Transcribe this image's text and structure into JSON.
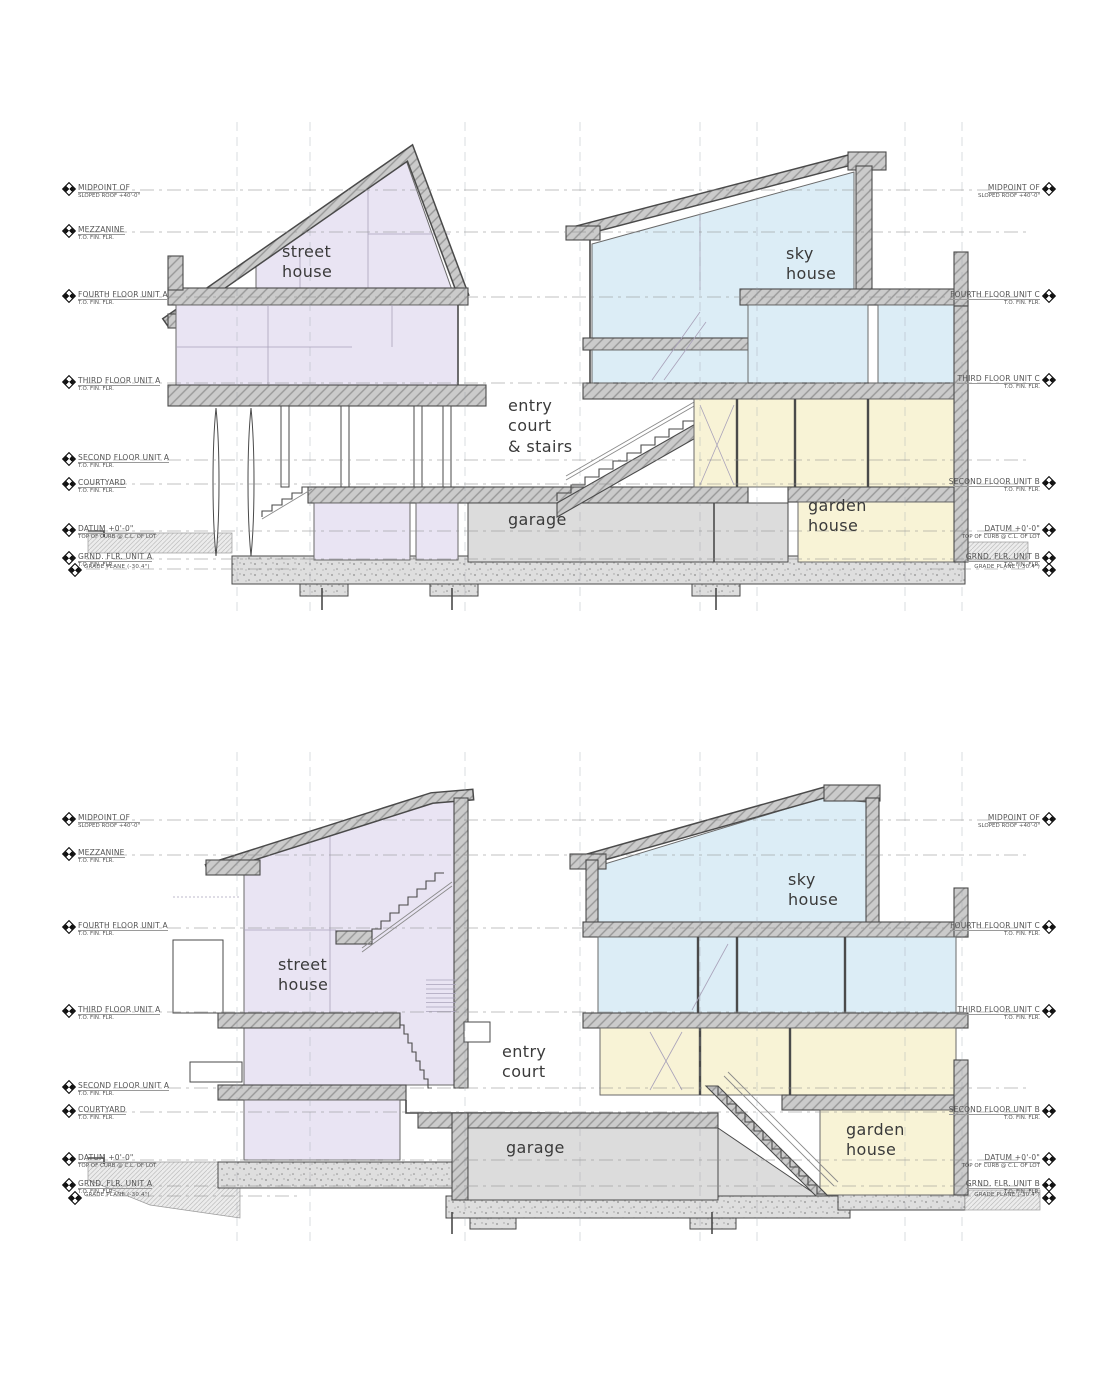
{
  "title": "residential building sections",
  "colors": {
    "street_house": "#e9e4f3",
    "sky_house": "#dcedf6",
    "garden_house": "#f8f3d6",
    "garage": "#dcdcdc",
    "concrete": "#cbcbcb",
    "line": "#4a4a4a"
  },
  "sections": [
    {
      "name": "upper section",
      "left_levels": [
        {
          "l1": "MIDPOINT OF",
          "l2": "SLOPED ROOF +40'-0\""
        },
        {
          "l1": "MEZZANINE",
          "l2": "T.O. FIN. FLR."
        },
        {
          "l1": "FOURTH FLOOR UNIT A",
          "l2": "T.O. FIN. FLR."
        },
        {
          "l1": "THIRD FLOOR UNIT A",
          "l2": "T.O. FIN. FLR."
        },
        {
          "l1": "SECOND FLOOR UNIT A",
          "l2": "T.O. FIN. FLR."
        },
        {
          "l1": "COURTYARD",
          "l2": "T.O. FIN. FLR."
        },
        {
          "l1": "DATUM +0'-0\"",
          "l2": "TOP OF CURB @ C.L. OF LOT"
        },
        {
          "l1": "GRND. FLR. UNIT A",
          "l2": "T.O. FIN. FLR."
        },
        {
          "l1": "GRADE PLANE (-30.4\")",
          "l2": ""
        }
      ],
      "right_levels": [
        {
          "l1": "MIDPOINT OF",
          "l2": "SLOPED ROOF +40'-0\""
        },
        {
          "l1": "FOURTH FLOOR UNIT C",
          "l2": "T.O. FIN. FLR."
        },
        {
          "l1": "THIRD FLOOR UNIT C",
          "l2": "T.O. FIN. FLR."
        },
        {
          "l1": "SECOND FLOOR UNIT B",
          "l2": "T.O. FIN. FLR."
        },
        {
          "l1": "DATUM +0'-0\"",
          "l2": "TOP OF CURB @ C.L. OF LOT"
        },
        {
          "l1": "GRND. FLR. UNIT B",
          "l2": "T.O. FIN. FLR."
        },
        {
          "l1": "GRADE PLANE (-30.4\")",
          "l2": ""
        }
      ],
      "rooms": [
        {
          "label": "street\nhouse"
        },
        {
          "label": "sky\nhouse"
        },
        {
          "label": "entry\ncourt\n& stairs"
        },
        {
          "label": "garage"
        },
        {
          "label": "garden\nhouse"
        }
      ]
    },
    {
      "name": "lower section",
      "left_levels": [
        {
          "l1": "MIDPOINT OF",
          "l2": "SLOPED ROOF +40'-0\""
        },
        {
          "l1": "MEZZANINE",
          "l2": "T.O. FIN. FLR."
        },
        {
          "l1": "FOURTH FLOOR UNIT A",
          "l2": "T.O. FIN. FLR."
        },
        {
          "l1": "THIRD FLOOR UNIT A",
          "l2": "T.O. FIN. FLR."
        },
        {
          "l1": "SECOND FLOOR UNIT A",
          "l2": "T.O. FIN. FLR."
        },
        {
          "l1": "COURTYARD",
          "l2": "T.O. FIN. FLR."
        },
        {
          "l1": "DATUM +0'-0\"",
          "l2": "TOP OF CURB @ C.L. OF LOT"
        },
        {
          "l1": "GRND. FLR. UNIT A",
          "l2": "T.O. FIN. FLR."
        },
        {
          "l1": "GRADE PLANE (-30.4\")",
          "l2": ""
        }
      ],
      "right_levels": [
        {
          "l1": "MIDPOINT OF",
          "l2": "SLOPED ROOF +40'-0\""
        },
        {
          "l1": "FOURTH FLOOR UNIT C",
          "l2": "T.O. FIN. FLR."
        },
        {
          "l1": "THIRD FLOOR UNIT C",
          "l2": "T.O. FIN. FLR."
        },
        {
          "l1": "SECOND FLOOR UNIT B",
          "l2": "T.O. FIN. FLR."
        },
        {
          "l1": "DATUM +0'-0\"",
          "l2": "TOP OF CURB @ C.L. OF LOT"
        },
        {
          "l1": "GRND. FLR. UNIT B",
          "l2": "T.O. FIN. FLR."
        },
        {
          "l1": "GRADE PLANE (-30.4\")",
          "l2": ""
        }
      ],
      "rooms": [
        {
          "label": "street\nhouse"
        },
        {
          "label": "sky\nhouse"
        },
        {
          "label": "entry\ncourt"
        },
        {
          "label": "garage"
        },
        {
          "label": "garden\nhouse"
        }
      ]
    }
  ]
}
